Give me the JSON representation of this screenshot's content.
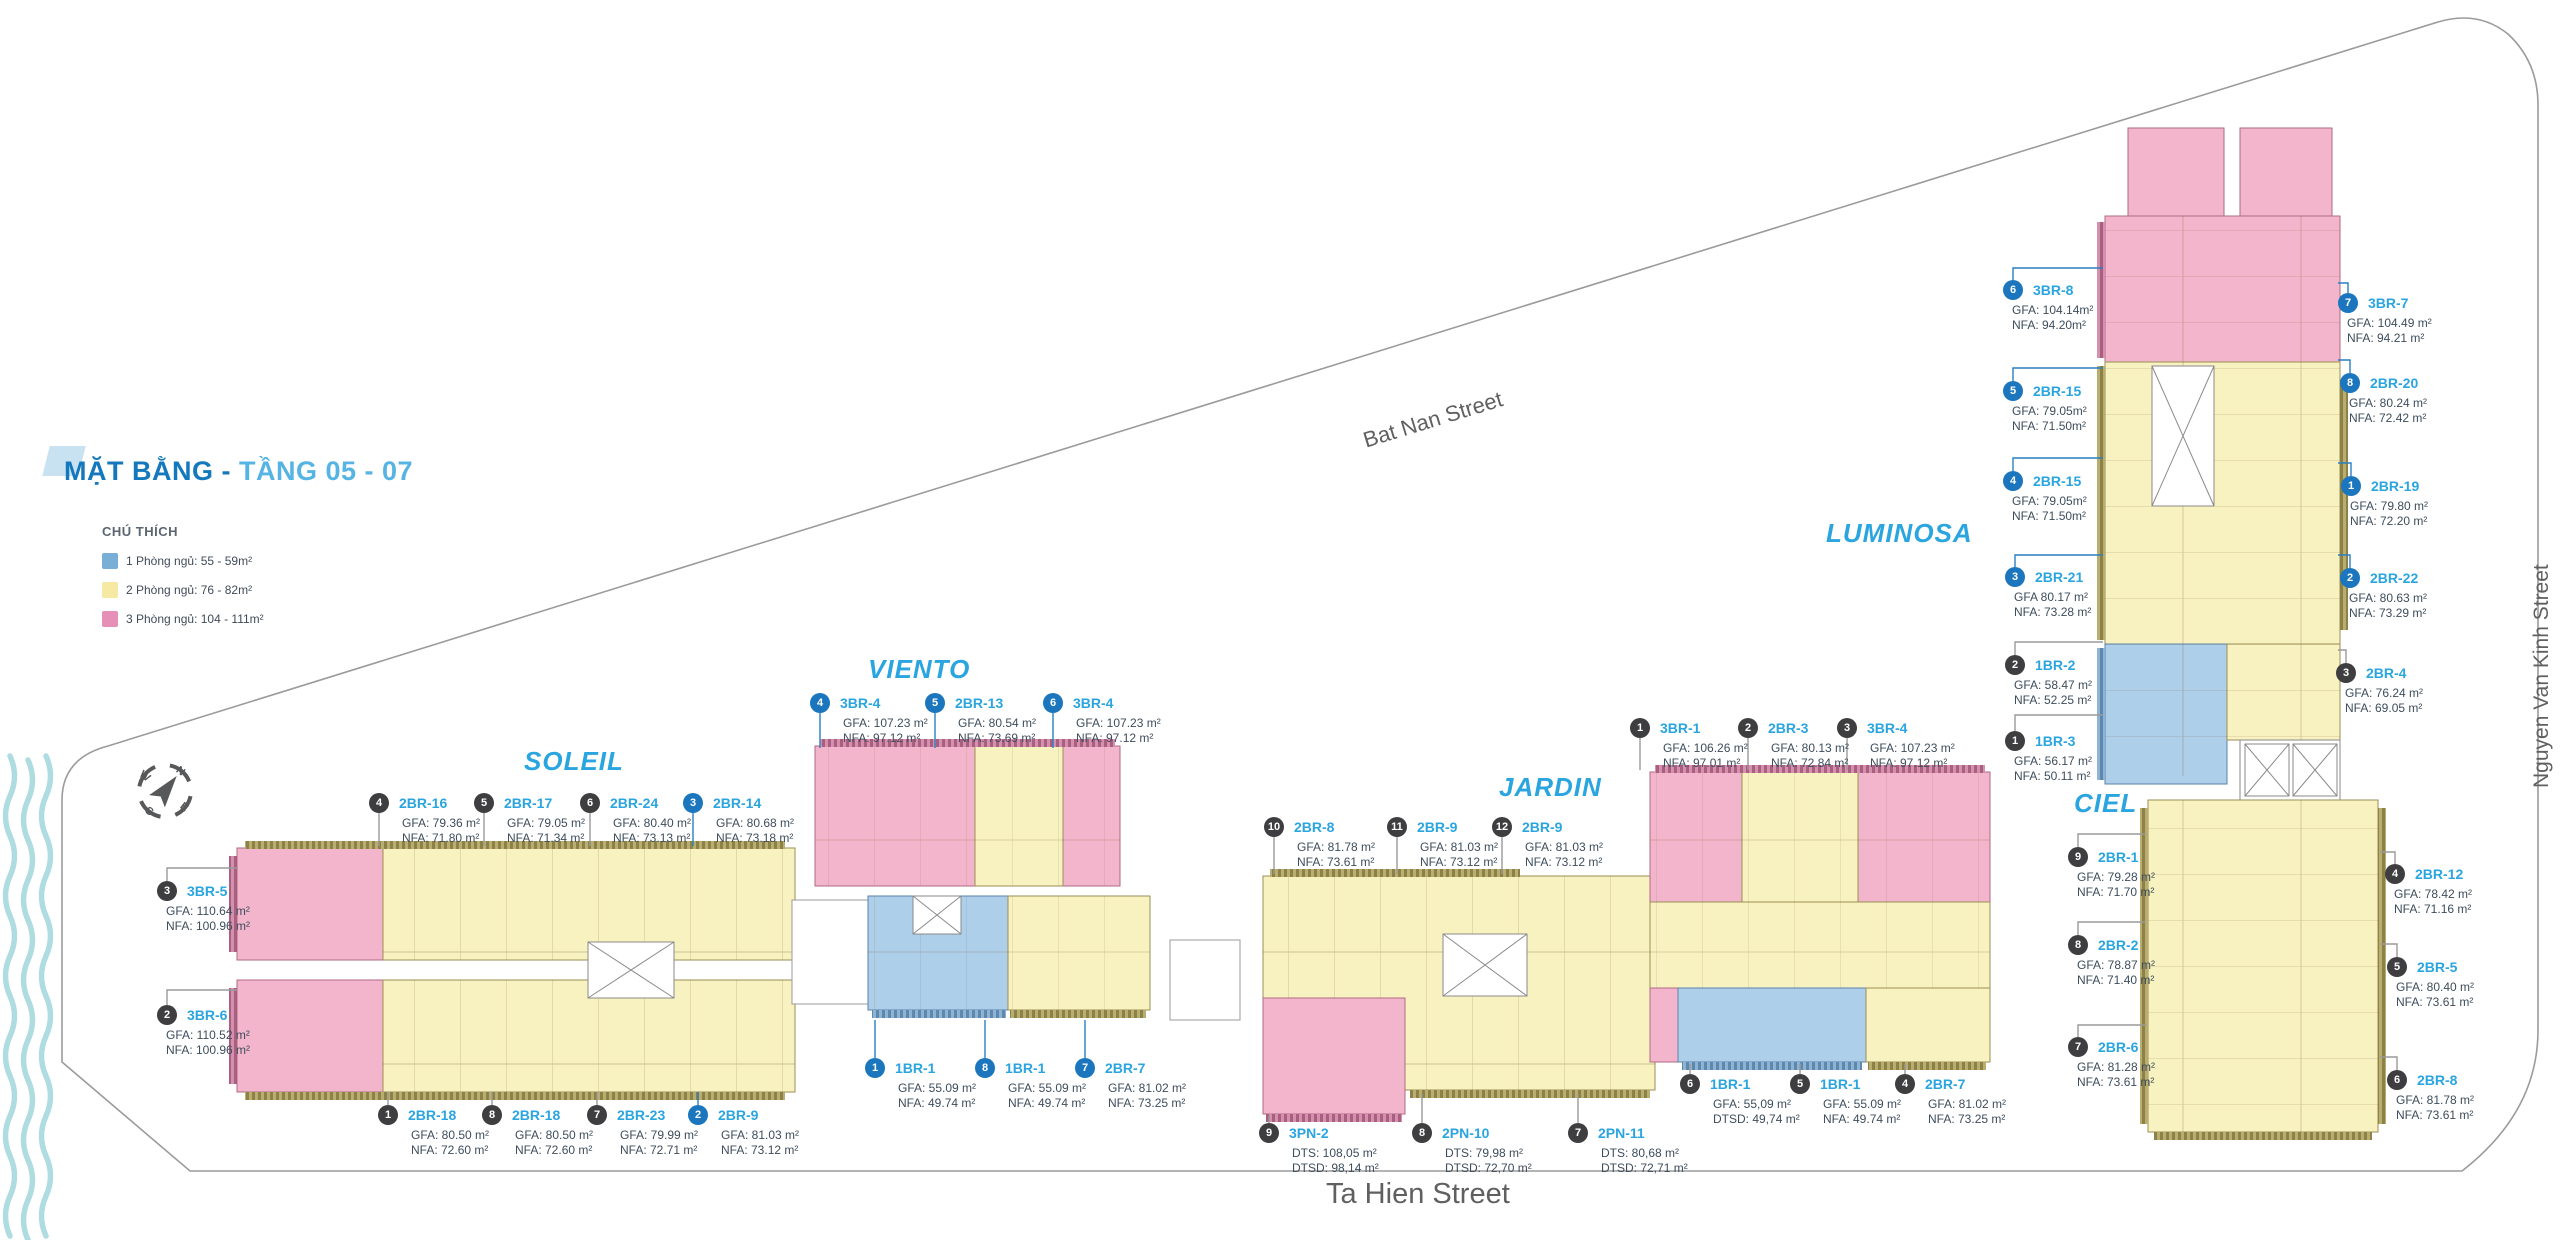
{
  "title": {
    "primary": "MẶT BẰNG -",
    "secondary": "TẦNG 05 - 07"
  },
  "legend": {
    "heading": "CHÚ THÍCH",
    "items": [
      {
        "label": "1 Phòng ngủ: 55 - 59m²",
        "color": "#79AFD6"
      },
      {
        "label": "2 Phòng ngủ: 76 - 82m²",
        "color": "#F6E9A4"
      },
      {
        "label": "3 Phòng ngủ: 104 - 111m²",
        "color": "#E68FB7"
      }
    ]
  },
  "streets": {
    "bat_nan": "Bat Nan Street",
    "ta_hien": "Ta Hien Street",
    "nguyen_van_kinh": "Nguyen Van Kinh Street"
  },
  "compass": {
    "n": "N",
    "e": "E",
    "s": "S",
    "w": "W"
  },
  "colors": {
    "unit_1br": "#AECFE9",
    "unit_2br": "#F8F2C0",
    "unit_3br": "#F3B5CB",
    "accent_blue": "#2AA5DF",
    "badge_dark": "#3E3E40",
    "badge_blue": "#1B76BE"
  },
  "towers": [
    {
      "name": "SOLEIL",
      "callouts": [
        {
          "num": "4",
          "style": "dark",
          "unit": "2BR-16",
          "line1": "GFA: 79.36 m²",
          "line2": "NFA: 71.80 m²",
          "x": 379,
          "y": 803,
          "indent": 33,
          "leader": "M379,813 L379,846"
        },
        {
          "num": "5",
          "style": "dark",
          "unit": "2BR-17",
          "line1": "GFA: 79.05 m²",
          "line2": "NFA: 71.34 m²",
          "x": 484,
          "y": 803,
          "indent": 33,
          "leader": "M484,813 L484,846"
        },
        {
          "num": "6",
          "style": "dark",
          "unit": "2BR-24",
          "line1": "GFA: 80.40 m²",
          "line2": "NFA: 73.13 m²",
          "x": 590,
          "y": 803,
          "indent": 33,
          "leader": "M590,813 L590,846"
        },
        {
          "num": "3",
          "style": "blue",
          "unit": "2BR-14",
          "line1": "GFA: 80.68 m²",
          "line2": "NFA: 73.18 m²",
          "x": 693,
          "y": 803,
          "indent": 33,
          "leader": "M693,813 L693,846"
        },
        {
          "num": "3",
          "style": "dark",
          "unit": "3BR-5",
          "line1": "GFA: 110.64 m²",
          "line2": "NFA: 100.96 m²",
          "x": 167,
          "y": 891,
          "indent": 9,
          "leader": "M167,881 L167,868 L237,868"
        },
        {
          "num": "2",
          "style": "dark",
          "unit": "3BR-6",
          "line1": "GFA: 110.52 m²",
          "line2": "NFA: 100.96 m²",
          "x": 167,
          "y": 1015,
          "indent": 9,
          "leader": "M167,1005 L167,990 L237,990"
        },
        {
          "num": "1",
          "style": "dark",
          "unit": "2BR-18",
          "line1": "GFA: 80.50 m²",
          "line2": "NFA: 72.60 m²",
          "x": 388,
          "y": 1115,
          "indent": 33,
          "leader": "M388,1105 L388,1092"
        },
        {
          "num": "8",
          "style": "dark",
          "unit": "2BR-18",
          "line1": "GFA: 80.50 m²",
          "line2": "NFA: 72.60 m²",
          "x": 492,
          "y": 1115,
          "indent": 33,
          "leader": "M492,1105 L492,1092"
        },
        {
          "num": "7",
          "style": "dark",
          "unit": "2BR-23",
          "line1": "GFA: 79.99 m²",
          "line2": "NFA: 72.71 m²",
          "x": 597,
          "y": 1115,
          "indent": 33,
          "leader": "M597,1105 L597,1092"
        },
        {
          "num": "2",
          "style": "blue",
          "unit": "2BR-9",
          "line1": "GFA: 81.03 m²",
          "line2": "NFA: 73.12 m²",
          "x": 698,
          "y": 1115,
          "indent": 33,
          "leader": "M698,1105 L698,1092"
        }
      ]
    },
    {
      "name": "VIENTO",
      "callouts": [
        {
          "num": "4",
          "style": "blue",
          "unit": "3BR-4",
          "line1": "GFA: 107.23 m²",
          "line2": "NFA: 97.12 m²",
          "x": 820,
          "y": 703,
          "indent": 33,
          "leader": "M820,713 L820,748"
        },
        {
          "num": "5",
          "style": "blue",
          "unit": "2BR-13",
          "line1": "GFA: 80.54 m²",
          "line2": "NFA: 73.69 m²",
          "x": 935,
          "y": 703,
          "indent": 33,
          "leader": "M935,713 L935,748"
        },
        {
          "num": "6",
          "style": "blue",
          "unit": "3BR-4",
          "line1": "GFA: 107.23 m²",
          "line2": "NFA: 97.12 m²",
          "x": 1053,
          "y": 703,
          "indent": 33,
          "leader": "M1053,713 L1053,748"
        },
        {
          "num": "1",
          "style": "blue",
          "unit": "1BR-1",
          "line1": "GFA: 55.09 m²",
          "line2": "NFA: 49.74 m²",
          "x": 875,
          "y": 1068,
          "indent": 33,
          "leader": "M875,1058 L875,1020"
        },
        {
          "num": "8",
          "style": "blue",
          "unit": "1BR-1",
          "line1": "GFA: 55.09 m²",
          "line2": "NFA: 49.74 m²",
          "x": 985,
          "y": 1068,
          "indent": 33,
          "leader": "M985,1058 L985,1020"
        },
        {
          "num": "7",
          "style": "blue",
          "unit": "2BR-7",
          "line1": "GFA: 81.02 m²",
          "line2": "NFA: 73.25 m²",
          "x": 1085,
          "y": 1068,
          "indent": 33,
          "leader": "M1085,1058 L1085,1020"
        }
      ]
    },
    {
      "name": "JARDIN",
      "callouts": [
        {
          "num": "10",
          "style": "dark",
          "unit": "2BR-8",
          "line1": "GFA: 81.78 m²",
          "line2": "NFA: 73.61 m²",
          "x": 1274,
          "y": 827,
          "indent": 33,
          "leader": "M1274,837 L1274,874"
        },
        {
          "num": "11",
          "style": "dark",
          "unit": "2BR-9",
          "line1": "GFA: 81.03 m²",
          "line2": "NFA: 73.12 m²",
          "x": 1397,
          "y": 827,
          "indent": 33,
          "leader": "M1397,837 L1397,874"
        },
        {
          "num": "12",
          "style": "dark",
          "unit": "2BR-9",
          "line1": "GFA: 81.03 m²",
          "line2": "NFA: 73.12 m²",
          "x": 1502,
          "y": 827,
          "indent": 33,
          "leader": "M1502,837 L1502,874"
        },
        {
          "num": "1",
          "style": "dark",
          "unit": "3BR-1",
          "line1": "GFA: 106.26 m²",
          "line2": "NFA: 97.01 m²",
          "x": 1640,
          "y": 728,
          "indent": 33,
          "leader": "M1640,738 L1640,770"
        },
        {
          "num": "2",
          "style": "dark",
          "unit": "2BR-3",
          "line1": "GFA: 80.13 m²",
          "line2": "NFA: 72.84 m²",
          "x": 1748,
          "y": 728,
          "indent": 33,
          "leader": "M1748,738 L1748,770"
        },
        {
          "num": "3",
          "style": "dark",
          "unit": "3BR-4",
          "line1": "GFA: 107.23 m²",
          "line2": "NFA: 97.12 m²",
          "x": 1847,
          "y": 728,
          "indent": 33,
          "leader": "M1847,738 L1847,770"
        },
        {
          "num": "6",
          "style": "dark",
          "unit": "1BR-1",
          "line1": "GFA: 55,09 m²",
          "line2": "DTSD: 49,74 m²",
          "x": 1690,
          "y": 1084,
          "indent": 33,
          "leader": "M1690,1074 L1690,1064"
        },
        {
          "num": "5",
          "style": "dark",
          "unit": "1BR-1",
          "line1": "GFA: 55.09 m²",
          "line2": "NFA: 49.74 m²",
          "x": 1800,
          "y": 1084,
          "indent": 33,
          "leader": "M1800,1074 L1800,1064"
        },
        {
          "num": "4",
          "style": "dark",
          "unit": "2BR-7",
          "line1": "GFA: 81.02 m²",
          "line2": "NFA: 73.25 m²",
          "x": 1905,
          "y": 1084,
          "indent": 33,
          "leader": "M1905,1074 L1905,1064"
        },
        {
          "num": "9",
          "style": "dark",
          "unit": "3PN-2",
          "line1": "DTS: 108,05 m²",
          "line2": "DTSD: 98,14 m²",
          "x": 1269,
          "y": 1133,
          "indent": 33,
          "leader": "M1269,1123 L1269,1116"
        },
        {
          "num": "8",
          "style": "dark",
          "unit": "2PN-10",
          "line1": "DTS: 79,98 m²",
          "line2": "DTSD: 72,70 m²",
          "x": 1422,
          "y": 1133,
          "indent": 33,
          "leader": "M1422,1123 L1422,1094"
        },
        {
          "num": "7",
          "style": "dark",
          "unit": "2PN-11",
          "line1": "DTS: 80,68 m²",
          "line2": "DTSD: 72,71 m²",
          "x": 1578,
          "y": 1133,
          "indent": 33,
          "leader": "M1578,1123 L1578,1094"
        }
      ]
    },
    {
      "name": "LUMINOSA",
      "callouts": [
        {
          "num": "6",
          "style": "blue",
          "unit": "3BR-8",
          "line1": "GFA: 104.14m²",
          "line2": "NFA: 94.20m²",
          "x": 2013,
          "y": 290,
          "indent": 9,
          "leader": "M2013,280 L2013,268 L2103,268"
        },
        {
          "num": "5",
          "style": "blue",
          "unit": "2BR-15",
          "line1": "GFA: 79.05m²",
          "line2": "NFA: 71.50m²",
          "x": 2013,
          "y": 391,
          "indent": 9,
          "leader": "M2013,381 L2013,368 L2103,368"
        },
        {
          "num": "4",
          "style": "blue",
          "unit": "2BR-15",
          "line1": "GFA: 79.05m²",
          "line2": "NFA: 71.50m²",
          "x": 2013,
          "y": 481,
          "indent": 9,
          "leader": "M2013,471 L2013,458 L2103,458"
        },
        {
          "num": "3",
          "style": "blue",
          "unit": "2BR-21",
          "line1": "GFA 80.17 m²",
          "line2": "NFA: 73.28 m²",
          "x": 2015,
          "y": 577,
          "indent": 9,
          "leader": "M2015,567 L2015,555 L2103,555"
        },
        {
          "num": "2",
          "style": "dark",
          "unit": "1BR-2",
          "line1": "GFA: 58.47 m²",
          "line2": "NFA: 52.25 m²",
          "x": 2015,
          "y": 665,
          "indent": 9,
          "leader": "M2015,655 L2015,642 L2103,642"
        },
        {
          "num": "1",
          "style": "dark",
          "unit": "1BR-3",
          "line1": "GFA: 56.17 m²",
          "line2": "NFA: 50.11 m²",
          "x": 2015,
          "y": 741,
          "indent": 9,
          "leader": "M2015,731 L2015,715 L2103,715"
        },
        {
          "num": "7",
          "style": "blue",
          "unit": "3BR-7",
          "line1": "GFA: 104.49 m²",
          "line2": "NFA: 94.21 m²",
          "x": 2348,
          "y": 303,
          "indent": 9,
          "leader": "M2348,293 L2348,283 L2338,283"
        },
        {
          "num": "8",
          "style": "blue",
          "unit": "2BR-20",
          "line1": "GFA: 80.24 m²",
          "line2": "NFA: 72.42 m²",
          "x": 2350,
          "y": 383,
          "indent": 9,
          "leader": "M2350,373 L2350,360 L2338,360"
        },
        {
          "num": "1",
          "style": "blue",
          "unit": "2BR-19",
          "line1": "GFA: 79.80 m²",
          "line2": "NFA: 72.20 m²",
          "x": 2351,
          "y": 486,
          "indent": 9,
          "leader": "M2351,476 L2351,463 L2338,463"
        },
        {
          "num": "2",
          "style": "blue",
          "unit": "2BR-22",
          "line1": "GFA: 80.63 m²",
          "line2": "NFA: 73.29 m²",
          "x": 2350,
          "y": 578,
          "indent": 9,
          "leader": "M2350,568 L2350,555 L2338,555"
        },
        {
          "num": "3",
          "style": "dark",
          "unit": "2BR-4",
          "line1": "GFA: 76.24 m²",
          "line2": "NFA: 69.05 m²",
          "x": 2346,
          "y": 673,
          "indent": 9,
          "leader": "M2346,663 L2346,650 L2338,650"
        }
      ]
    },
    {
      "name": "CIEL",
      "callouts": [
        {
          "num": "9",
          "style": "dark",
          "unit": "2BR-1",
          "line1": "GFA: 79.28 m²",
          "line2": "NFA: 71.70 m²",
          "x": 2078,
          "y": 857,
          "indent": 9,
          "leader": "M2078,847 L2078,834 L2146,834"
        },
        {
          "num": "8",
          "style": "dark",
          "unit": "2BR-2",
          "line1": "GFA: 78.87 m²",
          "line2": "NFA: 71.40 m²",
          "x": 2078,
          "y": 945,
          "indent": 9,
          "leader": "M2078,935 L2078,922 L2146,922"
        },
        {
          "num": "7",
          "style": "dark",
          "unit": "2BR-6",
          "line1": "GFA: 81.28 m²",
          "line2": "NFA: 73.61 m²",
          "x": 2078,
          "y": 1047,
          "indent": 9,
          "leader": "M2078,1037 L2078,1025 L2146,1025"
        },
        {
          "num": "4",
          "style": "dark",
          "unit": "2BR-12",
          "line1": "GFA: 78.42 m²",
          "line2": "NFA: 71.16 m²",
          "x": 2395,
          "y": 874,
          "indent": 9,
          "leader": "M2395,864 L2395,852 L2380,852"
        },
        {
          "num": "5",
          "style": "dark",
          "unit": "2BR-5",
          "line1": "GFA: 80.40 m²",
          "line2": "NFA: 73.61 m²",
          "x": 2397,
          "y": 967,
          "indent": 9,
          "leader": "M2397,957 L2397,944 L2380,944"
        },
        {
          "num": "6",
          "style": "dark",
          "unit": "2BR-8",
          "line1": "GFA: 81.78 m²",
          "line2": "NFA: 73.61 m²",
          "x": 2397,
          "y": 1080,
          "indent": 9,
          "leader": "M2397,1070 L2397,1057 L2380,1057"
        }
      ]
    }
  ]
}
